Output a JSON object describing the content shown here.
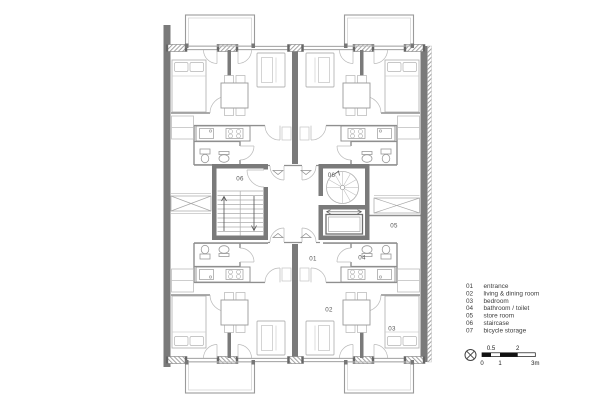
{
  "plan": {
    "room_labels": [
      {
        "name": "staircase-left",
        "text": "06"
      },
      {
        "name": "staircase-right",
        "text": "06"
      },
      {
        "name": "store-room",
        "text": "05"
      },
      {
        "name": "entrance",
        "text": "01"
      },
      {
        "name": "bathroom",
        "text": "04"
      },
      {
        "name": "living-dining",
        "text": "02"
      },
      {
        "name": "bedroom",
        "text": "03"
      }
    ]
  },
  "legend": {
    "items": [
      {
        "code": "01",
        "label": "entrance"
      },
      {
        "code": "02",
        "label": "living & dining room"
      },
      {
        "code": "03",
        "label": "bedroom"
      },
      {
        "code": "04",
        "label": "bathroom / toilet"
      },
      {
        "code": "05",
        "label": "store room"
      },
      {
        "code": "06",
        "label": "staircase"
      },
      {
        "code": "07",
        "label": "bicycle storage"
      }
    ]
  },
  "scale_bar": {
    "above": [
      "0.5",
      "2"
    ],
    "below": [
      "0",
      "1",
      "3m"
    ]
  },
  "icons": {
    "compass": "crossed-circle-icon"
  },
  "colors": {
    "wall": "#7a7a7a",
    "line_medium": "#8f8f8f",
    "furniture": "#b5b5b5",
    "text": "#3d3d3d",
    "scale_fill": "#111111"
  }
}
